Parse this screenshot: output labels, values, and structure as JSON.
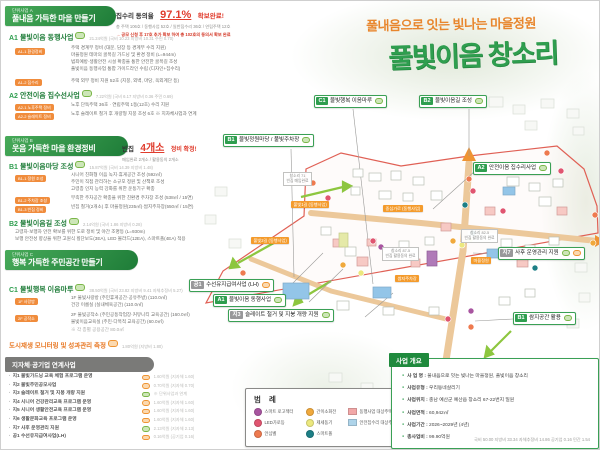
{
  "poster": {
    "subtitle": "풀내음으로 잇는 빛나는 마을정원",
    "title": "풀빛이음 창소리"
  },
  "sections": {
    "A": {
      "tag": "단위사업 A",
      "title": "풀내음 가득한 마을 만들기",
      "notice": {
        "label": "집수리 동의율",
        "value": "97.1%",
        "suffix": "확보완료!",
        "detail": "총 주택 106호 / 동행사업 52호 / 일반집수리 36호 / 연립주택 12호",
        "extra": "→ 공모 신청 후 17호 추가 확보 하여 총 102호의 동의서 확보 완료"
      },
      "a1": {
        "code": "A1",
        "title": "물빛이음 동행사업",
        "budget": "21.24억원 (국비 10.23 지방비 10.31 주민 0.70)",
        "sub1_tag": "A1-1 환경정비",
        "sub1_lines": [
          "주택 경계부 정비 (대문, 담장 등 경계부 수리 지원)",
          "마을정원 테마의 골목길 가드닝 및 환경 정비 (L=944m)",
          "범죄예방·생활안전 시설 확충을 통한 안전한 골목길 조성",
          "풀빛이음 동행사업 통합 가이드라인 수립 (디자인+집수리)"
        ],
        "sub2_tag": "A1-2 집수리",
        "sub2_lines": [
          "주택 외부 정비 지원 52호 (지붕, 외벽, 마당, 옥외계단 등)"
        ]
      },
      "a2": {
        "code": "A2",
        "title": "안전이음 집수선사업",
        "budget": "7.22억원 (국비 6.17 지방비 0.36 주민 0.69)",
        "sub1_tag": "A2-1 노후주택 정비",
        "sub1_lines": [
          "노후 단독주택 36호 · 연립주택 1동(12호) 수리 지원"
        ],
        "sub2_tag": "A2-2 슬레이트 정비",
        "sub2_lines": [
          "노후 슬레이트 철거 후 개량형 지붕 조성 6호 ※ 지자체사업과 연계"
        ]
      }
    },
    "B": {
      "tag": "단위사업 B",
      "title": "웃음 가득한 마을 환경정비",
      "notice": {
        "label": "빈집",
        "value": "4개소",
        "suffix": "정비 확정!",
        "detail": "매입완료 2개소 / 활용동의 2개소"
      },
      "b1": {
        "code": "B1",
        "title": "물빛이음마당 조성",
        "budget": "15.87억원 (국비 14.39 지방비 1.48)",
        "sub1_tag": "B1-1 정원 조성",
        "sub1_lines": [
          "시니어 친화형 이음 녹지·휴게공간 조성 (592㎡)",
          "주민이 직접 관리하는 소규모 정원 및 산책로 조성",
          "고령층 인지 능력 강화를 위한 운동기구 확충"
        ],
        "sub2_tag": "B1-2 주차장 조성",
        "sub2_lines": [
          "부족한 주차공간 확충을 위한 친환경 주차장 조성 (538㎡ / 15면)"
        ],
        "sub3_tag": "B1-3 빈집 정비",
        "sub3_lines": [
          "빈집 철거(2개소) 후 마을정원(235㎡)·쌈지주차장(550㎡ / 15면)"
        ]
      },
      "b2": {
        "code": "B2",
        "title": "물빛이음길 조성",
        "budget": "2.14억원 (국비 1.86 지방비 0.28)",
        "lines": [
          "고령자·보행자 안전 확보를 위한 도로 정비 및 야간 조명등 (L=930m)",
          "보행 안전성 향상을 위한 고원식 횡단보도(3EA), LED 볼라드(12EA), 스마트폴(4EA) 적용"
        ]
      }
    },
    "C": {
      "tag": "단위사업 C",
      "title": "행복 가득한 주민공간 만들기",
      "c1": {
        "code": "C1",
        "title": "물빛행복 이음마루",
        "budget": "38.50억원 (국비 23.82 지방비 9.41 자체추정비 5.27)",
        "sub1_tag": "1F 사랑방",
        "sub1_lines": [
          "1F 물빛사랑방 (주민휴게공간·공유주방) (110.0㎡)",
          "건강 이룸실 (실내체육공간) (110.0㎡)"
        ],
        "sub2_tag": "2F 공작소",
        "sub2_lines": [
          "2F 물빛공작소 (주민공동작업장·커뮤니티 교육공간) (160.0㎡)",
          "물빛이음교육실 (주민·다목적 교육공간) (60.0㎡)"
        ],
        "footnote": "※ 각 층별 공용공간 80.0㎡"
      }
    }
  },
  "monitoring": {
    "title": "도시재생 모니터링 및 성과관리 측정",
    "budget": "1.80억원 (지방비 1.80)"
  },
  "linked": {
    "title": "지자체·공기업 연계사업",
    "items": [
      {
        "name": "지1 물빛가드닝 교육 체험 프로그램 운영",
        "budget": "1.60억원 (지자체 1.60)"
      },
      {
        "name": "지2 물빛주민공모사업",
        "budget": "0.70억원 (지자체 0.70)"
      },
      {
        "name": "지3 슬레이트 철거 및 지붕 개량 지원",
        "budget": "※ 단위사업과 연계"
      },
      {
        "name": "지4 시니어 건강관리교육 프로그램 운영",
        "budget": "1.60억원 (지자체 1.60)"
      },
      {
        "name": "지5 시니어 생활안전교육 프로그램 운영",
        "budget": "1.60억원 (지자체 1.60)"
      },
      {
        "name": "지6 생활문화교육 프로그램 운영",
        "budget": "1.60억원 (지자체 1.60)"
      },
      {
        "name": "지7 사후 운영관리 지원",
        "budget": "2.13억원 (지자체 2.13)"
      },
      {
        "name": "공1 수선유지급여사업(LH)",
        "budget": "0.16억원 (공기업 0.16)"
      }
    ]
  },
  "map": {
    "labels": {
      "c1": {
        "code": "C1",
        "text": "물빛행복 이음마루"
      },
      "b2": {
        "code": "B2",
        "text": "물빛이음길 조성"
      },
      "b1": {
        "code": "B1",
        "text": "물빛정원마당 / 풀빛주차장"
      },
      "a2": {
        "code": "A2",
        "text": "안전이음 집수리사업"
      },
      "j7": {
        "code": "지7",
        "text": "사후 운영관리 지원"
      },
      "b1b": {
        "code": "B1",
        "text": "쌈지공간 활용"
      },
      "g1": {
        "code": "공1",
        "text": "수선유지급여사업 (LH)"
      },
      "a1": {
        "code": "A1",
        "text": "물빛이음 동행사업"
      },
      "j3": {
        "code": "지3",
        "text": "슬레이트 철거 및 지붕 개량 지원"
      }
    },
    "notes": {
      "n1": {
        "line1": "창소리 71",
        "line2": "빈집 매입완료"
      },
      "n2": {
        "line1": "창소리 87-5",
        "line2": "빈집 활용동의 완료"
      },
      "n3": {
        "line1": "창소리 82-5",
        "line2": "빈집 활용동의 완료"
      }
    },
    "roads": {
      "r1": "중심가로 (동행사업)",
      "r2": "풀빛1길 (동행사업)",
      "r3": "풀빛2길 (동행사업)",
      "r4": "마을정원",
      "r5": "쌈지주차장"
    }
  },
  "legend": {
    "title": "범 례",
    "dots": [
      {
        "label": "스마트 로고젝터",
        "color": "#a855a0"
      },
      {
        "label": "LED가로등",
        "color": "#e05570"
      },
      {
        "label": "안심벨",
        "color": "#ee7a4f"
      },
      {
        "label": "간이소화전",
        "color": "#f0a93c"
      },
      {
        "label": "제세동기",
        "color": "#ece87e"
      },
      {
        "label": "스마트폴",
        "color": "#1d7f86"
      }
    ],
    "squares": [
      {
        "label": "동행사업 대상주택",
        "color": "#f2a8a8"
      },
      {
        "label": "안전집수리 대상주택",
        "color": "#aed4ea"
      }
    ]
  },
  "overview": {
    "title": "사업 개요",
    "rows": [
      {
        "label": "사 업 명",
        "value": "풀내음으로 잇는 빛나는 마을정원, 풀빛이음 창소리"
      },
      {
        "label": "사업유형",
        "value": "우리동네살리기"
      },
      {
        "label": "사업위치",
        "value": "충남 예산군 예산읍 창소리 67-22번지 일원"
      },
      {
        "label": "사업면적",
        "value": "60,942㎡"
      },
      {
        "label": "사업기간",
        "value": "2026~2029년 (4년)"
      },
      {
        "label": "총사업비",
        "value": "99.90억원"
      }
    ],
    "footnote": "국비 50.00 지방비 33.34 자체추정비 14.86 공기업 0.16 민간 1.54"
  }
}
